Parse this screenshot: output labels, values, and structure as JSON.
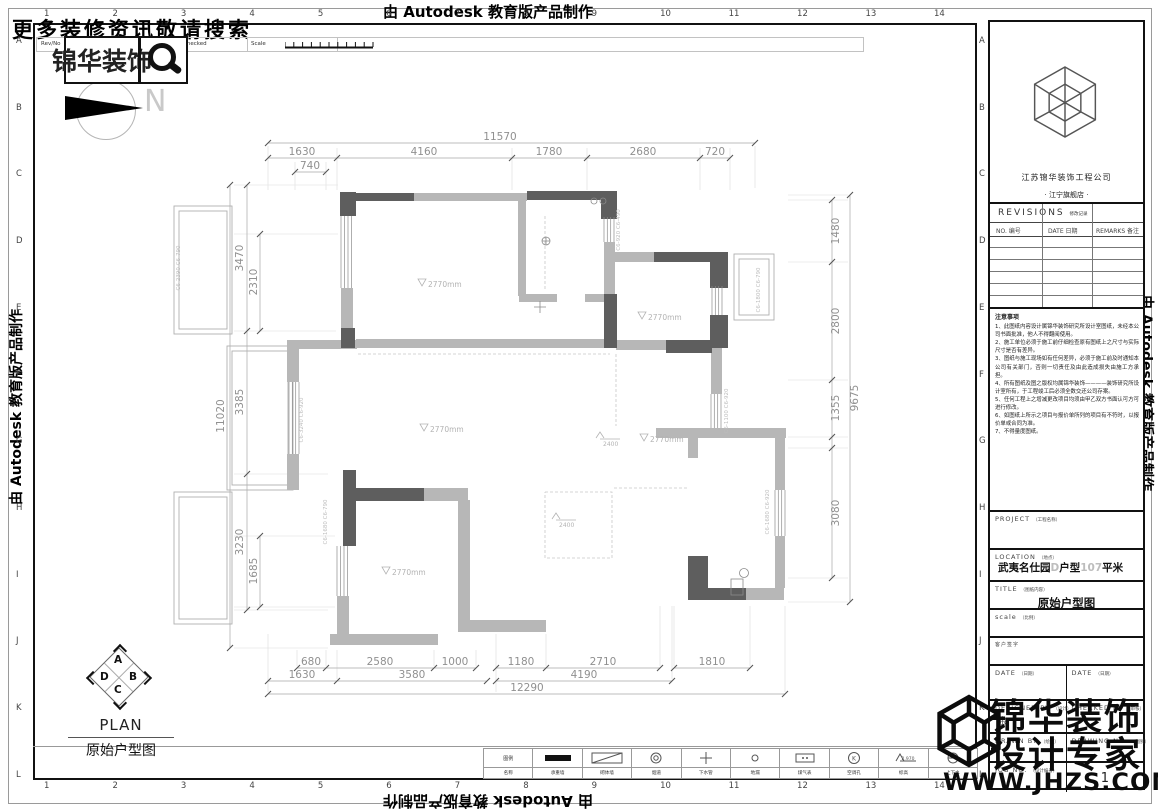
{
  "banner": {
    "top": "由 Autodesk 教育版产品制作",
    "bottom": "由 Autodesk 教育版产品制作",
    "left": "由 Autodesk 教育版产品制作",
    "right": "由 Autodesk 教育版产品制作"
  },
  "header": {
    "promo": "更多装修资讯敬请搜索",
    "logo_text": "锦华装饰",
    "rev_no": "Rev/No",
    "revision_note": "Revision note",
    "signature": "Signature",
    "checked": "Checked",
    "scale": "Scale",
    "north": "N"
  },
  "grid": {
    "cols": [
      "1",
      "2",
      "3",
      "4",
      "5",
      "6",
      "7",
      "8",
      "9",
      "10",
      "11",
      "12",
      "13",
      "14"
    ],
    "rows": [
      "A",
      "B",
      "C",
      "D",
      "E",
      "F",
      "G",
      "H",
      "I",
      "J",
      "K",
      "L"
    ]
  },
  "title_block": {
    "company": "江苏锦华装饰工程公司",
    "store": "· 江宁旗舰店 ·",
    "revisions_en": "REVISIONS",
    "revisions_cn": "修改记录",
    "col_no": "NO. 编号",
    "col_date": "DATE 日期",
    "col_remarks": "REMARKS 备注",
    "notes_title": "注意事项",
    "notes": [
      "1、此图纸内容设计属锦华装饰研究所设计室图纸，未经本公司书面批准，他人不得翻阅使用。",
      "2、施工单位必须于施工前仔细检查原有图纸上之尺寸与实际尺寸是否有差异。",
      "3、图纸与施工现场如有任何差异，必须于施工前及时通知本公司有关部门，否则一切责任及由此造成损失由施工方承担。",
      "4、所有图纸及图之版权均属锦华装饰————装饰研究所设计室所有，于工程竣工后必须全数交还公司存案。",
      "5、任何工程上之增减更改项目均须由甲乙双方书面认可方可进行修改。",
      "6、如图纸上所示之项目与报价单所列的项目有不符时，以报价单或合同为准。",
      "7、不得量度图纸。"
    ],
    "project_label": "PROJECT",
    "project_label_cn": "（工程名称）",
    "location_label": "LOCATION",
    "location_label_cn": "（地点）",
    "loc_part1": "武夷名仕园",
    "loc_part2": "D",
    "loc_part3": "户型",
    "loc_part4": "107",
    "loc_part5": "平米",
    "title_label": "TITLE",
    "title_label_cn": "（图纸内容）",
    "title_value": "原始户型图",
    "scale_label": "scale",
    "scale_label_cn": "（比例）",
    "client_sign": "客户签字",
    "date_label": "DATE",
    "date_label_cn": "（日期）",
    "designed_by": "DESIGNED BY",
    "designed_by_cn": "（设计）",
    "designer": "余",
    "checked_by": "CHECKED BY",
    "checked_by_cn": "（审核）",
    "drawn_by": "DRAWN BY",
    "drawn_by_cn": "（绘图）",
    "drawing_no_label": "DRAWING NO.",
    "drawing_no_label_cn": "（图别）",
    "job_no_label": "JOB NO.",
    "job_no_label_cn": "（设计编号）",
    "drawing_no": "1"
  },
  "watermark": {
    "line1": "锦华装饰",
    "line2": "设计专家",
    "url": "WWW.JHZS.COM"
  },
  "plan": {
    "label_en": "PLAN",
    "label_cn": "原始户型图",
    "compass": {
      "top": "A",
      "right": "B",
      "bottom": "C",
      "left": "D"
    },
    "dims": {
      "top_total": "11570",
      "top_segs": [
        "1630",
        "4160",
        "1780",
        "2680",
        "720"
      ],
      "top_sub": "740",
      "left_total": "11020",
      "left_mid": [
        "3470",
        "3385",
        "3230"
      ],
      "left_inner": [
        "2310",
        "1685"
      ],
      "right_total": "9675",
      "right_segs": [
        "1480",
        "2800",
        "1355",
        "3080"
      ],
      "bottom_r1": [
        "680",
        "2580",
        "1000",
        "1180",
        "2710",
        "1810"
      ],
      "bottom_r2": [
        "1630",
        "3580",
        "4190"
      ],
      "bottom_total": "12290"
    },
    "height_marks": [
      "2770mm",
      "2770mm",
      "2770mm",
      "2770mm",
      "2770mm"
    ],
    "level_marks": [
      "2400",
      "2400"
    ],
    "window_labels": [
      "C6-2390 C6-790",
      "C6-920 C6-490",
      "C6-1800 C6-790",
      "C6-3240 C6-920",
      "C6-1100 C6-920",
      "C6-1680 C6-920",
      "C6-1680 C6-790"
    ]
  },
  "legend": {
    "header_top": "图例",
    "header_bottom": "名称",
    "items": [
      {
        "label": "承重墙"
      },
      {
        "label": "砌体墙"
      },
      {
        "label": "烟道"
      },
      {
        "label": "下水管"
      },
      {
        "label": "地漏"
      },
      {
        "label": "煤气表"
      },
      {
        "label": "空调孔",
        "letter": "K"
      },
      {
        "label": "标高",
        "value": "2.970"
      },
      {
        "label": "上下水"
      }
    ]
  }
}
